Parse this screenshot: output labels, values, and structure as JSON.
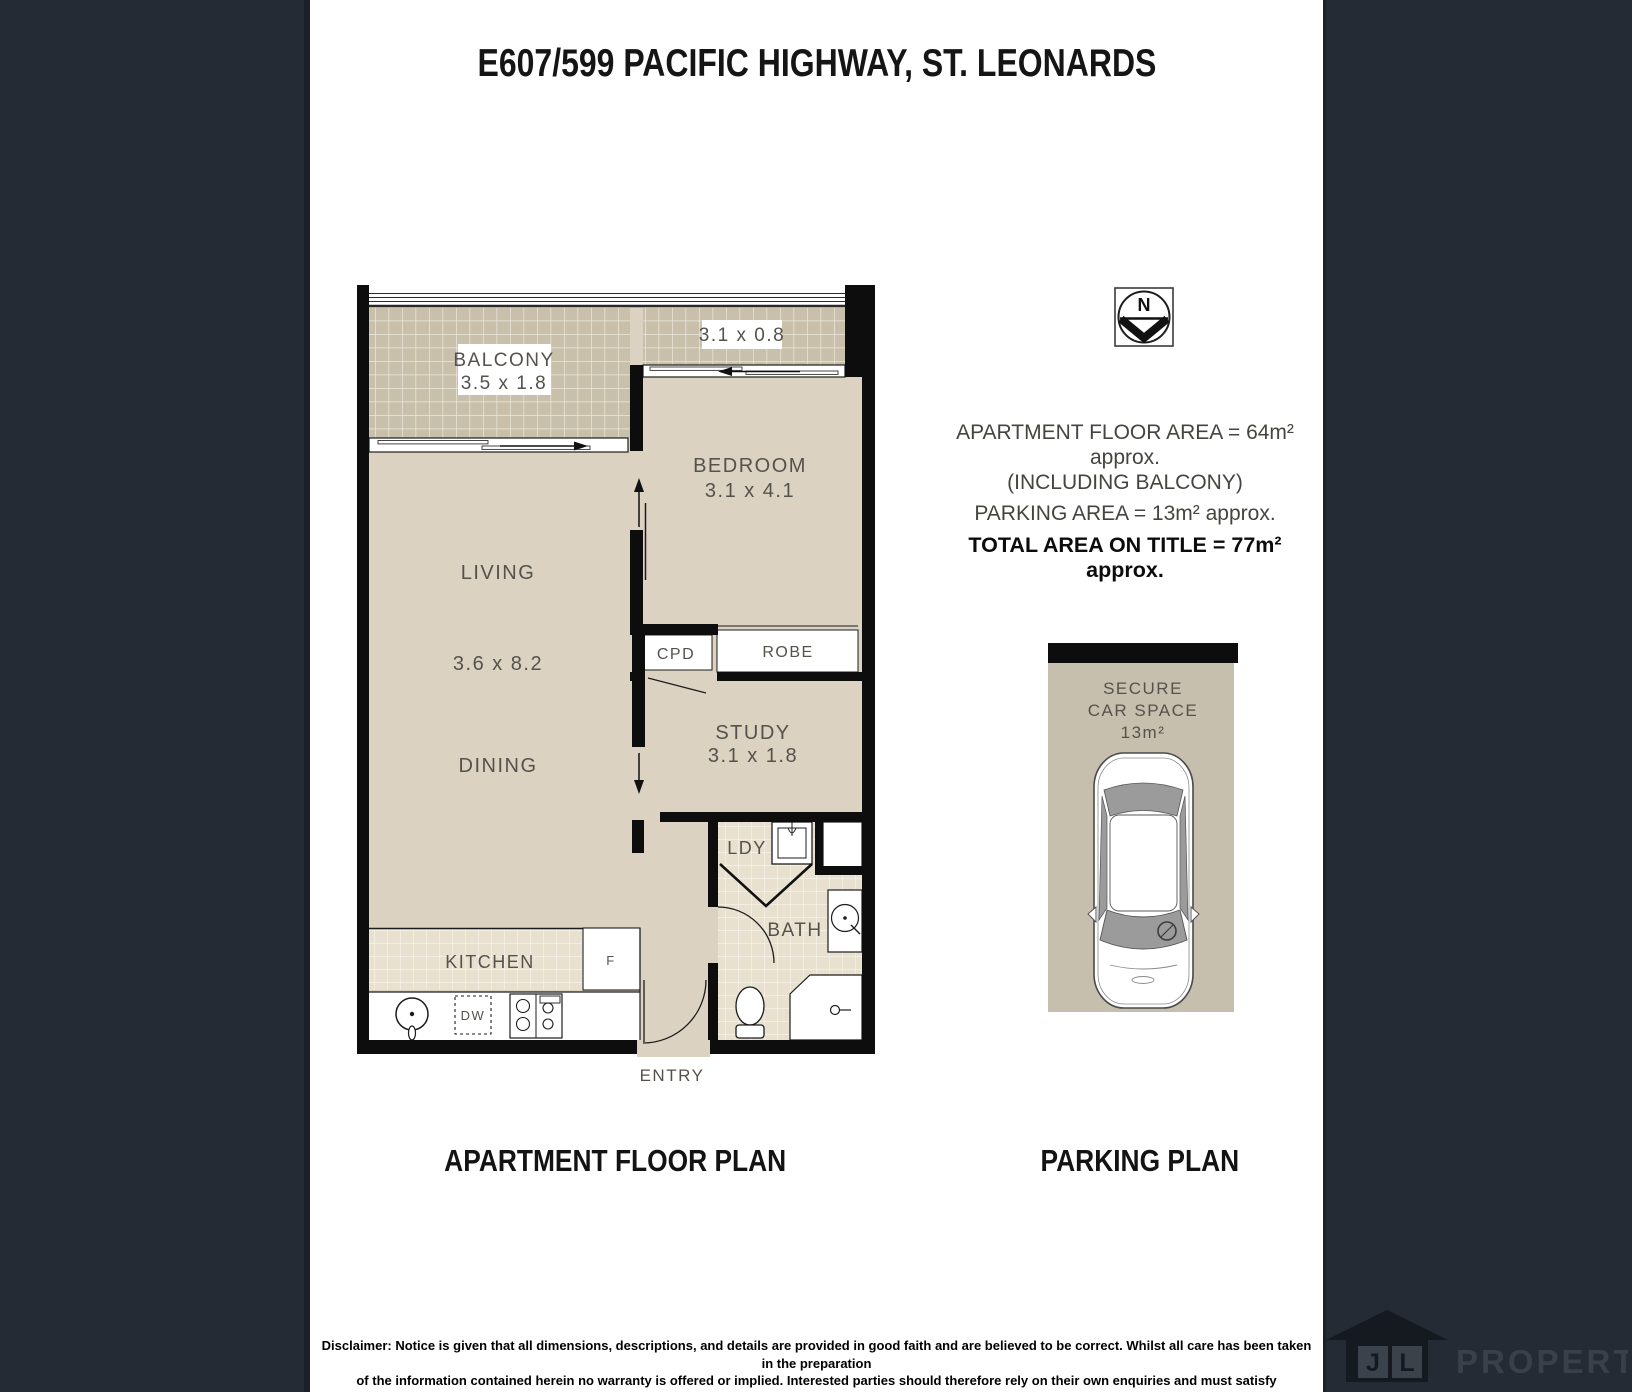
{
  "page": {
    "title": "E607/599 PACIFIC HIGHWAY, ST. LEONARDS"
  },
  "compass": {
    "north_label": "N"
  },
  "area_summary": {
    "line1": "APARTMENT FLOOR AREA = 64m² approx.",
    "line2": "(INCLUDING BALCONY)",
    "line3": "PARKING AREA = 13m² approx.",
    "line4": "TOTAL AREA ON TITLE = 77m² approx."
  },
  "floor_plan": {
    "caption": "APARTMENT FLOOR PLAN",
    "entry_label": "ENTRY",
    "rooms": {
      "balcony": {
        "name": "BALCONY",
        "dims": "3.5 x 1.8"
      },
      "balcony_side_dims": "3.1 x 0.8",
      "bedroom": {
        "name": "BEDROOM",
        "dims": "3.1 x 4.1"
      },
      "living": {
        "name": "LIVING",
        "dims": "3.6 x 8.2"
      },
      "dining": {
        "name": "DINING"
      },
      "study": {
        "name": "STUDY",
        "dims": "3.1 x 1.8"
      },
      "cupboard": "CPD",
      "robe": "ROBE",
      "laundry": "LDY",
      "bath": "BATH",
      "kitchen": "KITCHEN",
      "fridge": "F",
      "dishwasher": "DW"
    }
  },
  "parking_plan": {
    "caption": "PARKING PLAN",
    "space_line1": "SECURE",
    "space_line2": "CAR SPACE",
    "space_line3": "13m²"
  },
  "disclaimer": {
    "line1": "Disclaimer: Notice is given that all dimensions, descriptions, and details are provided in good faith and are believed to be correct. Whilst all care has been taken in the preparation",
    "line2": "of the information contained herein no warranty is offered or implied. Interested parties should therefore rely on their own enquiries and must satisfy themselves in all respects"
  },
  "logo": {
    "monogram_j": "J",
    "monogram_l": "L",
    "brand": "PROPERTY"
  },
  "colors": {
    "floor_fill": "#DCD2C1",
    "balcony_tile": "#C8C0AB",
    "wet_area_tile": "#E9E1CF",
    "wall": "#0D0D0D",
    "parking_fill": "#C7BFAE",
    "sidebar": "#242B34",
    "label_text": "#55524C"
  }
}
